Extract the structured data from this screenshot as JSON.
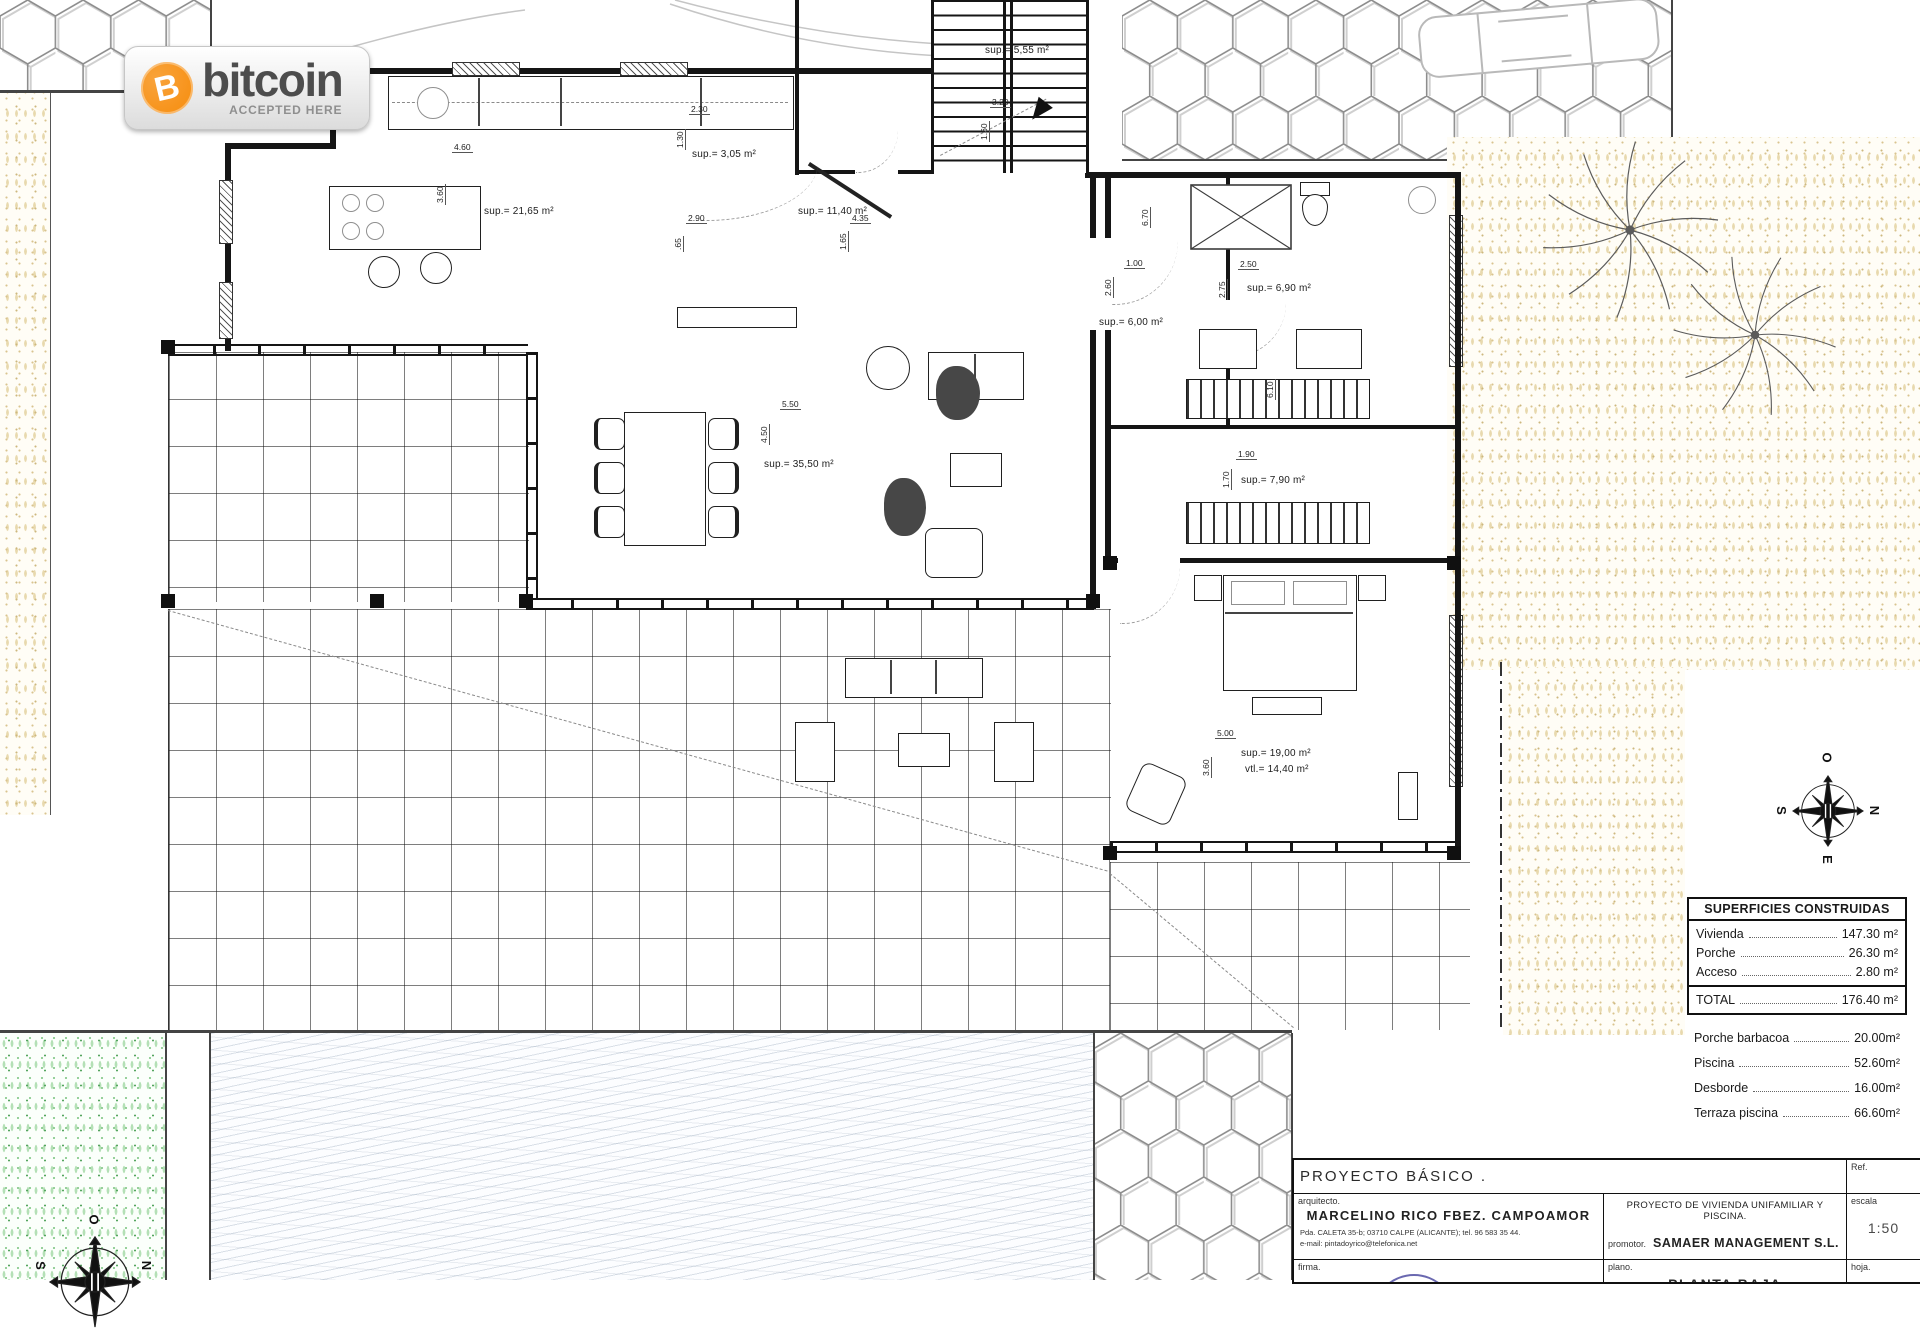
{
  "badge": {
    "symbol": "B",
    "brand": "bitcoin",
    "tagline": "ACCEPTED HERE",
    "coin_color": "#f7931a",
    "text_color": "#4d4d4d"
  },
  "plan": {
    "room_labels": [
      "sup.= 21,65 m²",
      "sup.= 3,05 m²",
      "sup.= 11,40 m²",
      "sup.= 5,55 m²",
      "sup.= 6,00 m²",
      "sup.= 6,90 m²",
      "sup.= 7,90 m²",
      "sup.= 19,00 m²",
      "vtl.= 14,40 m²",
      "sup.= 35,50 m²"
    ],
    "dimensions": [
      "4.60",
      "3.60",
      "2.30",
      "1.30",
      "2.90",
      ".65",
      "4.35",
      "1.65",
      "3.20",
      "1.60",
      "1.00",
      "2.60",
      "2.50",
      "2.75",
      "6.70",
      "6.10",
      "1.90",
      "1.70",
      "5.00",
      "3.60",
      "5.50",
      "4.50"
    ]
  },
  "areas_table": {
    "title": "SUPERFICIES CONSTRUIDAS",
    "rows": [
      {
        "label": "Vivienda",
        "value": "147.30 m²"
      },
      {
        "label": "Porche",
        "value": "26.30 m²"
      },
      {
        "label": "Acceso",
        "value": "2.80 m²"
      }
    ],
    "total": {
      "label": "TOTAL",
      "value": "176.40 m²"
    },
    "extra_rows": [
      {
        "label": "Porche barbacoa",
        "value": "20.00m²"
      },
      {
        "label": "Piscina",
        "value": "52.60m²"
      },
      {
        "label": "Desborde",
        "value": "16.00m²"
      },
      {
        "label": "Terraza piscina",
        "value": "66.60m²"
      }
    ]
  },
  "title_block": {
    "project_type": "PROYECTO  BÁSICO  .",
    "ref_label": "Ref.",
    "arquitecto_label": "arquitecto.",
    "architect_name": "MARCELINO RICO FBEZ. CAMPOAMOR",
    "address": "Pda. CALETA 35-b; 03710 CALPE (ALICANTE); tel. 96 583 35 44.",
    "email": "e-mail: pintadoyrico@telefonica.net",
    "project_title": "PROYECTO DE VIVIENDA UNIFAMILIAR Y PISCINA.",
    "promotor_label": "promotor.",
    "promotor_name": "SAMAER MANAGEMENT S.L.",
    "escala_label": "escala",
    "escala_value": "1:50",
    "firma_label": "firma.",
    "plano_label": "plano.",
    "plano_value": "PLANTA BAJA",
    "hoja_label": "hoja."
  },
  "compass": {
    "top": "O",
    "right": "N",
    "bottom": "E",
    "left": "S"
  }
}
